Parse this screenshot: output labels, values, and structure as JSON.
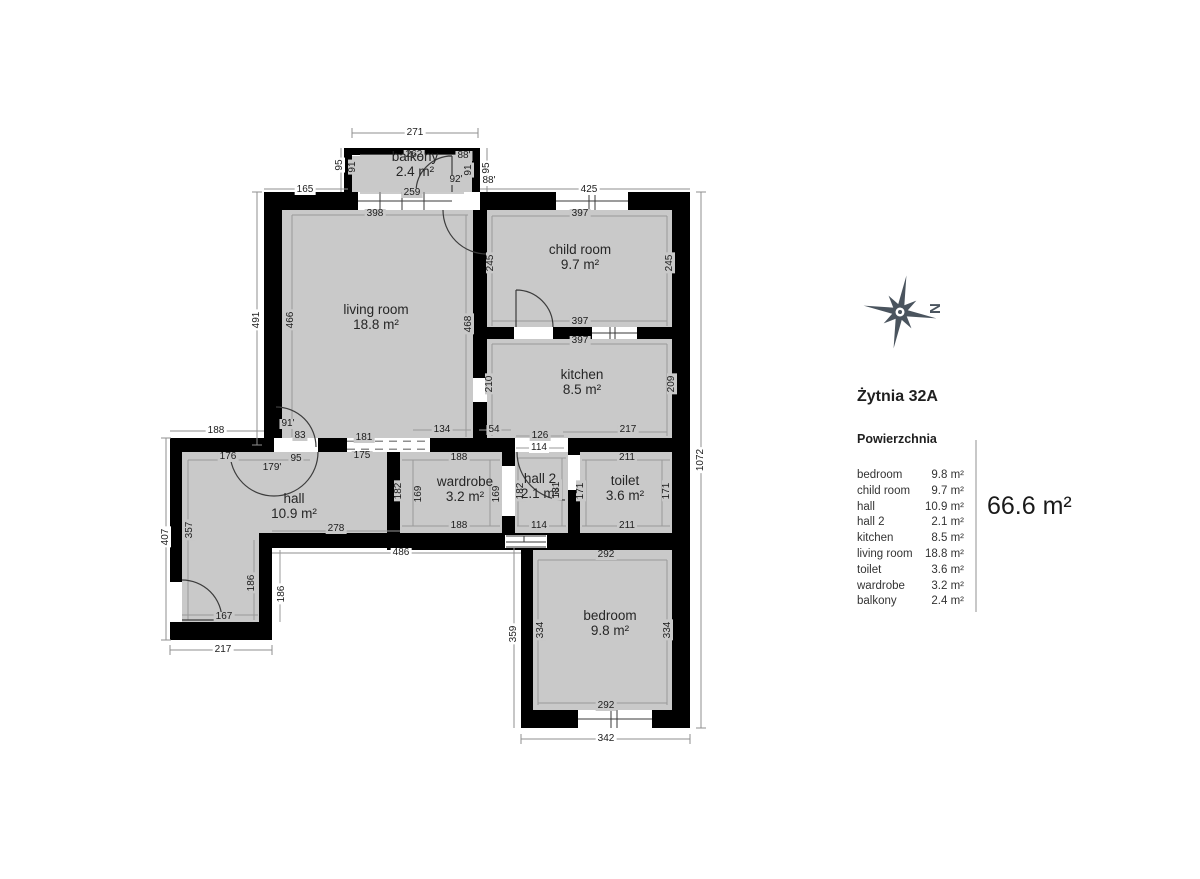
{
  "title": "Żytnia 32A",
  "legend": {
    "header": "Powierzchnia",
    "rows": [
      {
        "name": "bedroom",
        "area": "9.8 m²"
      },
      {
        "name": "child room",
        "area": "9.7 m²"
      },
      {
        "name": "hall",
        "area": "10.9 m²"
      },
      {
        "name": "hall 2",
        "area": "2.1 m²"
      },
      {
        "name": "kitchen",
        "area": "8.5 m²"
      },
      {
        "name": "living room",
        "area": "18.8 m²"
      },
      {
        "name": "toilet",
        "area": "3.6 m²"
      },
      {
        "name": "wardrobe",
        "area": "3.2 m²"
      },
      {
        "name": "balkony",
        "area": "2.4 m²"
      }
    ],
    "total": "66.6 m²"
  },
  "compass": {
    "label": "N"
  },
  "colors": {
    "room_fill": "#c9c9c9",
    "wall": "#000000",
    "compass": "#4a545e",
    "dim_line": "#8f8f8f"
  },
  "rooms": [
    {
      "label": "balkony",
      "area": "2.4 m²",
      "x": 415,
      "y": 157
    },
    {
      "label": "living room",
      "area": "18.8 m²",
      "x": 376,
      "y": 310
    },
    {
      "label": "child room",
      "area": "9.7 m²",
      "x": 580,
      "y": 250
    },
    {
      "label": "kitchen",
      "area": "8.5 m²",
      "x": 582,
      "y": 375
    },
    {
      "label": "hall",
      "area": "10.9 m²",
      "x": 294,
      "y": 499
    },
    {
      "label": "wardrobe",
      "area": "3.2 m²",
      "x": 465,
      "y": 482
    },
    {
      "label": "hall 2",
      "area": "2.1 m²",
      "x": 540,
      "y": 479
    },
    {
      "label": "toilet",
      "area": "3.6 m²",
      "x": 625,
      "y": 481
    },
    {
      "label": "bedroom",
      "area": "9.8 m²",
      "x": 610,
      "y": 616
    }
  ],
  "dimensions": [
    {
      "t": "271",
      "x": 415,
      "y": 133,
      "r": 0,
      "bg": "w"
    },
    {
      "t": "262",
      "x": 414,
      "y": 155,
      "r": 0,
      "bg": "g"
    },
    {
      "t": "259",
      "x": 412,
      "y": 193,
      "r": 0,
      "bg": "g"
    },
    {
      "t": "88'",
      "x": 464,
      "y": 156,
      "r": 0,
      "bg": "g"
    },
    {
      "t": "92'",
      "x": 456,
      "y": 180,
      "r": 0,
      "bg": "g"
    },
    {
      "t": "88'",
      "x": 489,
      "y": 181,
      "r": 0,
      "bg": "w"
    },
    {
      "t": "95",
      "x": 340,
      "y": 165,
      "r": 1,
      "bg": "w"
    },
    {
      "t": "91",
      "x": 353,
      "y": 167,
      "r": 1,
      "bg": "g"
    },
    {
      "t": "95",
      "x": 487,
      "y": 168,
      "r": 1,
      "bg": "w"
    },
    {
      "t": "91",
      "x": 469,
      "y": 170,
      "r": 1,
      "bg": "g"
    },
    {
      "t": "165",
      "x": 305,
      "y": 190,
      "r": 0,
      "bg": "w"
    },
    {
      "t": "425",
      "x": 589,
      "y": 190,
      "r": 0,
      "bg": "w"
    },
    {
      "t": "398",
      "x": 375,
      "y": 214,
      "r": 0,
      "bg": "g"
    },
    {
      "t": "397",
      "x": 580,
      "y": 214,
      "r": 0,
      "bg": "g"
    },
    {
      "t": "491",
      "x": 257,
      "y": 320,
      "r": 1,
      "bg": "w"
    },
    {
      "t": "466",
      "x": 291,
      "y": 320,
      "r": 1,
      "bg": "g"
    },
    {
      "t": "468",
      "x": 469,
      "y": 324,
      "r": 1,
      "bg": "g"
    },
    {
      "t": "245",
      "x": 491,
      "y": 263,
      "r": 1,
      "bg": "g"
    },
    {
      "t": "245",
      "x": 670,
      "y": 263,
      "r": 1,
      "bg": "g"
    },
    {
      "t": "397",
      "x": 580,
      "y": 322,
      "r": 0,
      "bg": "g"
    },
    {
      "t": "397",
      "x": 580,
      "y": 341,
      "r": 0,
      "bg": "g"
    },
    {
      "t": "210",
      "x": 490,
      "y": 384,
      "r": 1,
      "bg": "g"
    },
    {
      "t": "209",
      "x": 672,
      "y": 384,
      "r": 1,
      "bg": "g"
    },
    {
      "t": "1072",
      "x": 701,
      "y": 460,
      "r": 1,
      "bg": "w"
    },
    {
      "t": "188",
      "x": 216,
      "y": 431,
      "r": 0,
      "bg": "w"
    },
    {
      "t": "91'",
      "x": 288,
      "y": 424,
      "r": 0,
      "bg": "g"
    },
    {
      "t": "83",
      "x": 300,
      "y": 436,
      "r": 0,
      "bg": "g"
    },
    {
      "t": "181",
      "x": 364,
      "y": 438,
      "r": 0,
      "bg": "g"
    },
    {
      "t": "175",
      "x": 362,
      "y": 456,
      "r": 0,
      "bg": "g"
    },
    {
      "t": "134",
      "x": 442,
      "y": 430,
      "r": 0,
      "bg": "g"
    },
    {
      "t": "54",
      "x": 494,
      "y": 430,
      "r": 0,
      "bg": "g"
    },
    {
      "t": "126",
      "x": 540,
      "y": 436,
      "r": 0,
      "bg": "g"
    },
    {
      "t": "114",
      "x": 539,
      "y": 448,
      "r": 0,
      "bg": "w"
    },
    {
      "t": "217",
      "x": 628,
      "y": 430,
      "r": 0,
      "bg": "g"
    },
    {
      "t": "176",
      "x": 228,
      "y": 457,
      "r": 0,
      "bg": "g"
    },
    {
      "t": "95",
      "x": 296,
      "y": 459,
      "r": 0,
      "bg": "g"
    },
    {
      "t": "179'",
      "x": 272,
      "y": 468,
      "r": 0,
      "bg": "g"
    },
    {
      "t": "188",
      "x": 459,
      "y": 458,
      "r": 0,
      "bg": "g"
    },
    {
      "t": "211",
      "x": 627,
      "y": 458,
      "r": 0,
      "bg": "g"
    },
    {
      "t": "182",
      "x": 399,
      "y": 491,
      "r": 1,
      "bg": "g"
    },
    {
      "t": "169",
      "x": 419,
      "y": 494,
      "r": 1,
      "bg": "g"
    },
    {
      "t": "169",
      "x": 497,
      "y": 494,
      "r": 1,
      "bg": "g"
    },
    {
      "t": "182",
      "x": 521,
      "y": 491,
      "r": 1,
      "bg": "g"
    },
    {
      "t": "181",
      "x": 557,
      "y": 490,
      "r": 1,
      "bg": "g"
    },
    {
      "t": "171",
      "x": 581,
      "y": 491,
      "r": 1,
      "bg": "g"
    },
    {
      "t": "171",
      "x": 667,
      "y": 491,
      "r": 1,
      "bg": "g"
    },
    {
      "t": "188",
      "x": 459,
      "y": 526,
      "r": 0,
      "bg": "g"
    },
    {
      "t": "114",
      "x": 539,
      "y": 526,
      "r": 0,
      "bg": "g"
    },
    {
      "t": "211",
      "x": 627,
      "y": 526,
      "r": 0,
      "bg": "g"
    },
    {
      "t": "357",
      "x": 190,
      "y": 530,
      "r": 1,
      "bg": "g"
    },
    {
      "t": "407",
      "x": 166,
      "y": 537,
      "r": 1,
      "bg": "w"
    },
    {
      "t": "278",
      "x": 336,
      "y": 529,
      "r": 0,
      "bg": "g"
    },
    {
      "t": "486",
      "x": 401,
      "y": 553,
      "r": 0,
      "bg": "w"
    },
    {
      "t": "186",
      "x": 252,
      "y": 583,
      "r": 1,
      "bg": "g"
    },
    {
      "t": "186",
      "x": 282,
      "y": 594,
      "r": 1,
      "bg": "w"
    },
    {
      "t": "167",
      "x": 224,
      "y": 617,
      "r": 0,
      "bg": "g"
    },
    {
      "t": "217",
      "x": 223,
      "y": 650,
      "r": 0,
      "bg": "w"
    },
    {
      "t": "292",
      "x": 606,
      "y": 555,
      "r": 0,
      "bg": "g"
    },
    {
      "t": "359",
      "x": 514,
      "y": 634,
      "r": 1,
      "bg": "w"
    },
    {
      "t": "334",
      "x": 541,
      "y": 630,
      "r": 1,
      "bg": "g"
    },
    {
      "t": "334",
      "x": 668,
      "y": 630,
      "r": 1,
      "bg": "g"
    },
    {
      "t": "292",
      "x": 606,
      "y": 706,
      "r": 0,
      "bg": "g"
    },
    {
      "t": "342",
      "x": 606,
      "y": 739,
      "r": 0,
      "bg": "w"
    }
  ]
}
